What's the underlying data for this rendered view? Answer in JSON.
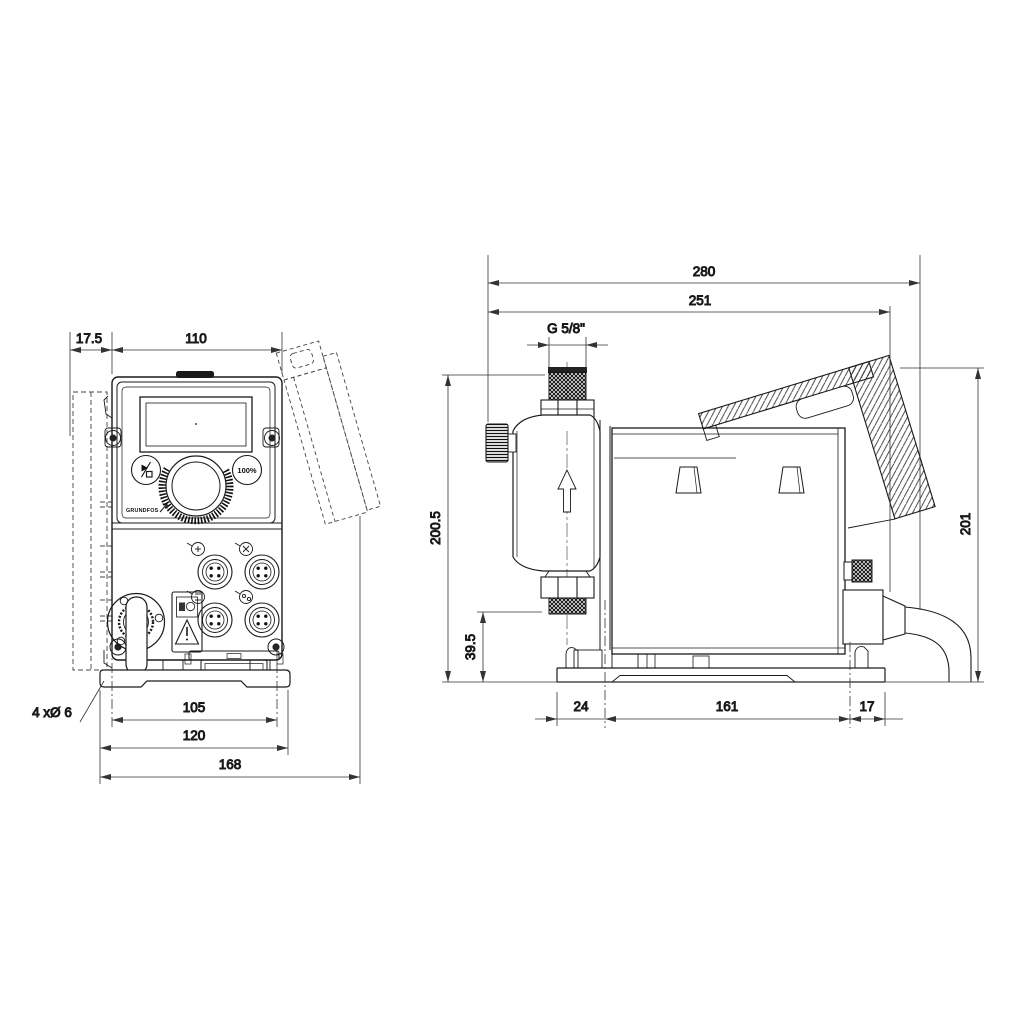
{
  "drawing": {
    "front": {
      "dim_offset": "17.5",
      "dim_width": "110",
      "dim_hole_spacing": "105",
      "dim_plate_width": "120",
      "dim_total_width": "168",
      "holes_label": "4 xØ 6",
      "button_capacity": "100%",
      "brand": "GRUNDFOS"
    },
    "side": {
      "dim_total_length": "280",
      "dim_length": "251",
      "thread_label": "G 5/8\"",
      "dim_height": "200.5",
      "dim_connection_height": "39.5",
      "dim_front_offset": "24",
      "dim_hole_spacing": "161",
      "dim_rear_offset": "17",
      "dim_total_height": "201"
    },
    "icons": {
      "start_stop": "play-stop-icon",
      "flow": "arrow-up-icon",
      "warning": "triangle-exclamation-icon"
    }
  }
}
